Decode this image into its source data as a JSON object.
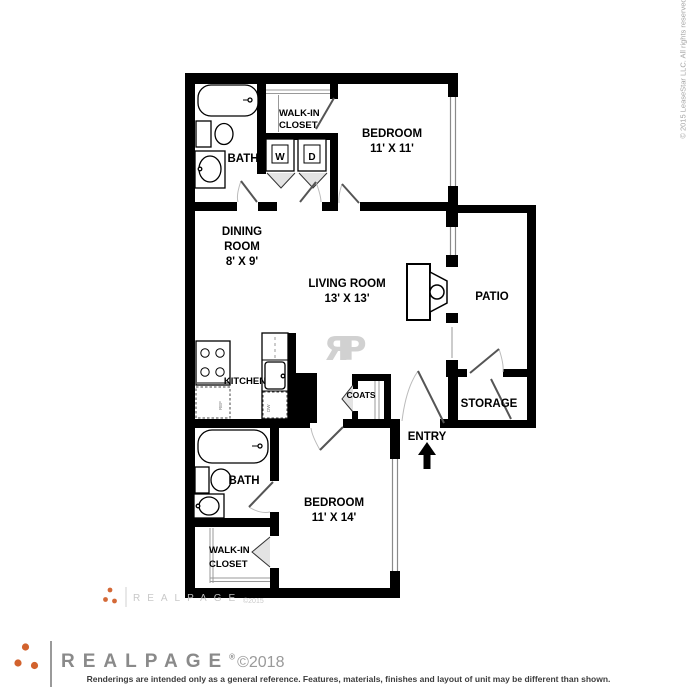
{
  "side_copyright": "© 2015 LeaseStar LLC. All rights reserved.",
  "colors": {
    "wall": "#000000",
    "accent_orange": "#D2622D",
    "logo_gray": "#8a8a8a",
    "watermark_gray": "#c6c6c6",
    "disclaimer_gray": "#3d3d3d",
    "background": "#ffffff"
  },
  "rooms": {
    "bedroom1": {
      "label": "BEDROOM",
      "dims": "11' X 11'"
    },
    "bedroom2": {
      "label": "BEDROOM",
      "dims": "11' X 14'"
    },
    "living": {
      "label": "LIVING ROOM",
      "dims": "13' X 13'"
    },
    "dining": {
      "line1": "DINING",
      "line2": "ROOM",
      "dims": "8' X 9'"
    },
    "bath1": {
      "label": "BATH"
    },
    "bath2": {
      "label": "BATH"
    },
    "closet1": {
      "line1": "WALK-IN",
      "line2": "CLOSET"
    },
    "closet2": {
      "line1": "WALK-IN",
      "line2": "CLOSET"
    },
    "kitchen": {
      "label": "KITCHEN"
    },
    "coats": {
      "label": "COATS"
    },
    "patio": {
      "label": "PATIO"
    },
    "storage": {
      "label": "STORAGE"
    },
    "entry": {
      "label": "ENTRY"
    }
  },
  "appliances": {
    "washer": "W",
    "dryer": "D",
    "fridge": "REF",
    "dishwasher": "DW"
  },
  "watermark": {
    "monogram": "ЯP",
    "brand": "REALPAGE",
    "year": "©2015"
  },
  "footer": {
    "brand": "REALPAGE",
    "registered": "®",
    "year": "©2018",
    "disclaimer": "Renderings are intended only as a general reference. Features, materials, finishes and layout of unit may be different than shown."
  }
}
